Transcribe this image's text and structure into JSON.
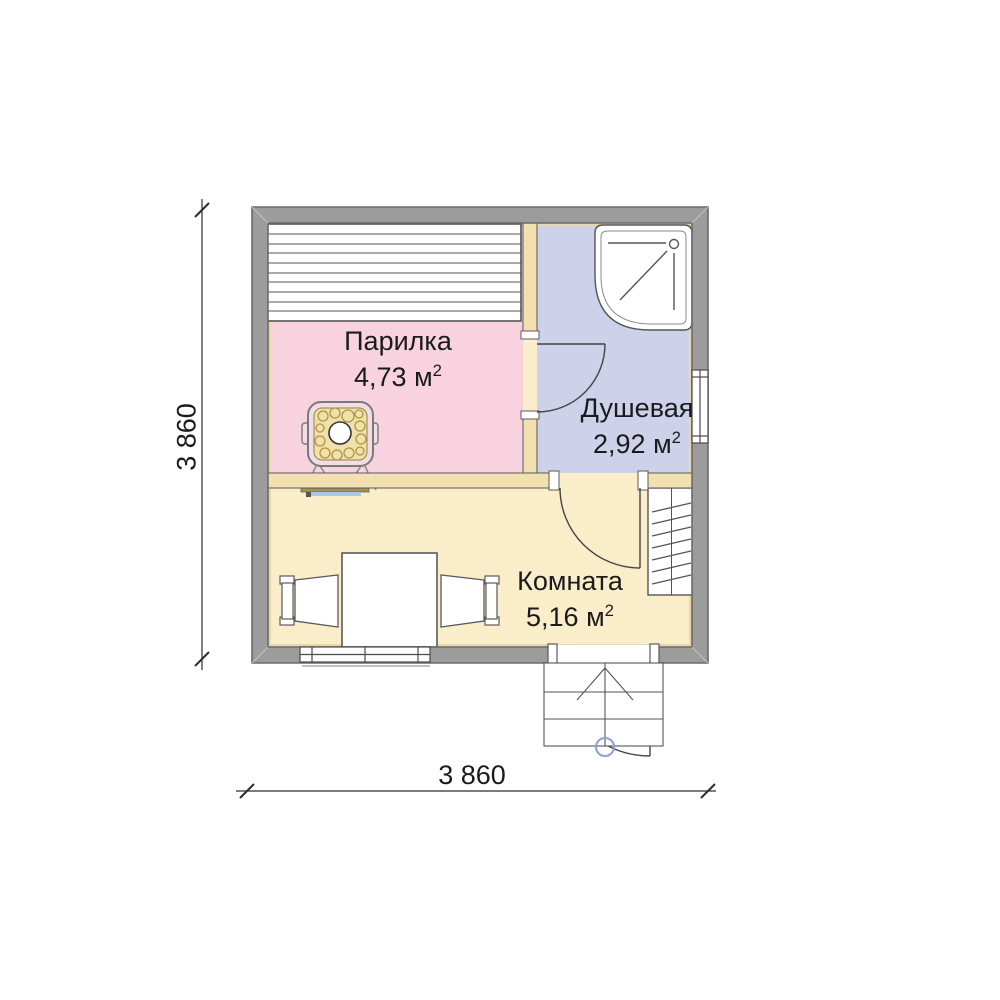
{
  "rooms": [
    {
      "name": "Парилка",
      "area": "4,73 м",
      "area_sup": "2"
    },
    {
      "name": "Душевая",
      "area": "2,92 м",
      "area_sup": "2"
    },
    {
      "name": "Комната",
      "area": "5,16 м",
      "area_sup": "2"
    }
  ],
  "dimensions": {
    "bottom": "3 860",
    "left": "3 860"
  },
  "colors": {
    "wall": "#9c9c9c",
    "wall_outline": "#6b6b6b",
    "partition": "#f2e0b0",
    "room_parilka": "#f8d2de",
    "room_dushevaya": "#cdd1e9",
    "room_komnata": "#faedca",
    "accent_blue": "#8e9ede",
    "accent_blue_light": "#a9c7e6",
    "stone_gold": "#b3953f"
  }
}
